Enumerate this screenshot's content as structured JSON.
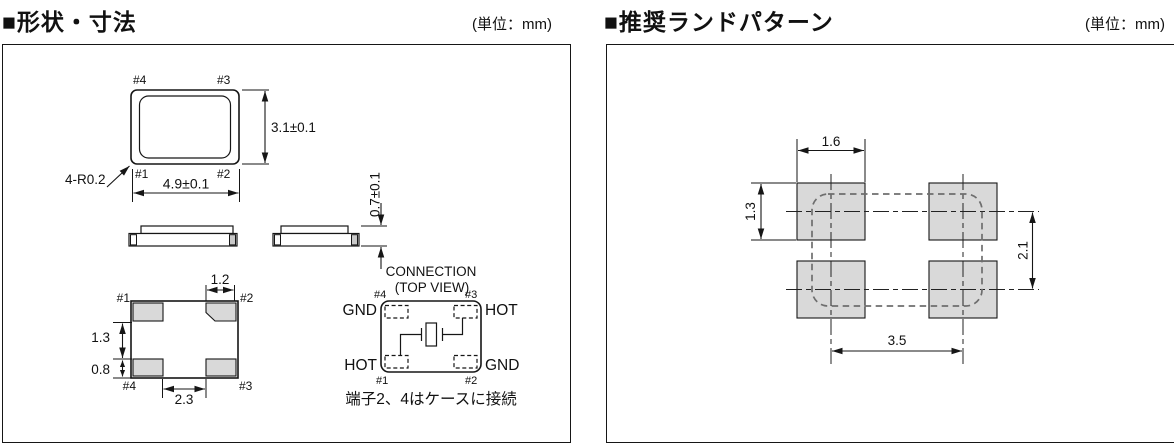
{
  "shape_panel": {
    "title": "■形状・寸法",
    "unit": "(単位：mm)",
    "top_view": {
      "pin4": "#4",
      "pin3": "#3",
      "pin1": "#1",
      "pin2": "#2",
      "width": "4.9±0.1",
      "height": "3.1±0.1",
      "corner_radius": "4-R0.2"
    },
    "side_view": {
      "thickness": "0.7±0.1"
    },
    "bottom_view": {
      "pin1": "#1",
      "pin2": "#2",
      "pin4": "#4",
      "pin3": "#3",
      "pad_width": "1.2",
      "pad_pitch": "1.3",
      "pad_height": "0.8",
      "pad_gap": "2.3"
    },
    "connection_view": {
      "title": "CONNECTION",
      "subtitle": "(TOP VIEW)",
      "pin4": "#4",
      "pin3": "#3",
      "pin1": "#1",
      "pin2": "#2",
      "gnd_tl": "GND",
      "hot_tr": "HOT",
      "hot_bl": "HOT",
      "gnd_br": "GND",
      "note": "端子2、4はケースに接続"
    }
  },
  "land_panel": {
    "title": "■推奨ランドパターン",
    "unit": "(単位：mm)",
    "pad_width": "1.6",
    "pad_height": "1.3",
    "vertical_pitch": "2.1",
    "horizontal_pitch": "3.5"
  },
  "colors": {
    "pad_fill": "#d9d9d9",
    "line": "#161616",
    "body_outline_dash": "#6e6e6e"
  }
}
